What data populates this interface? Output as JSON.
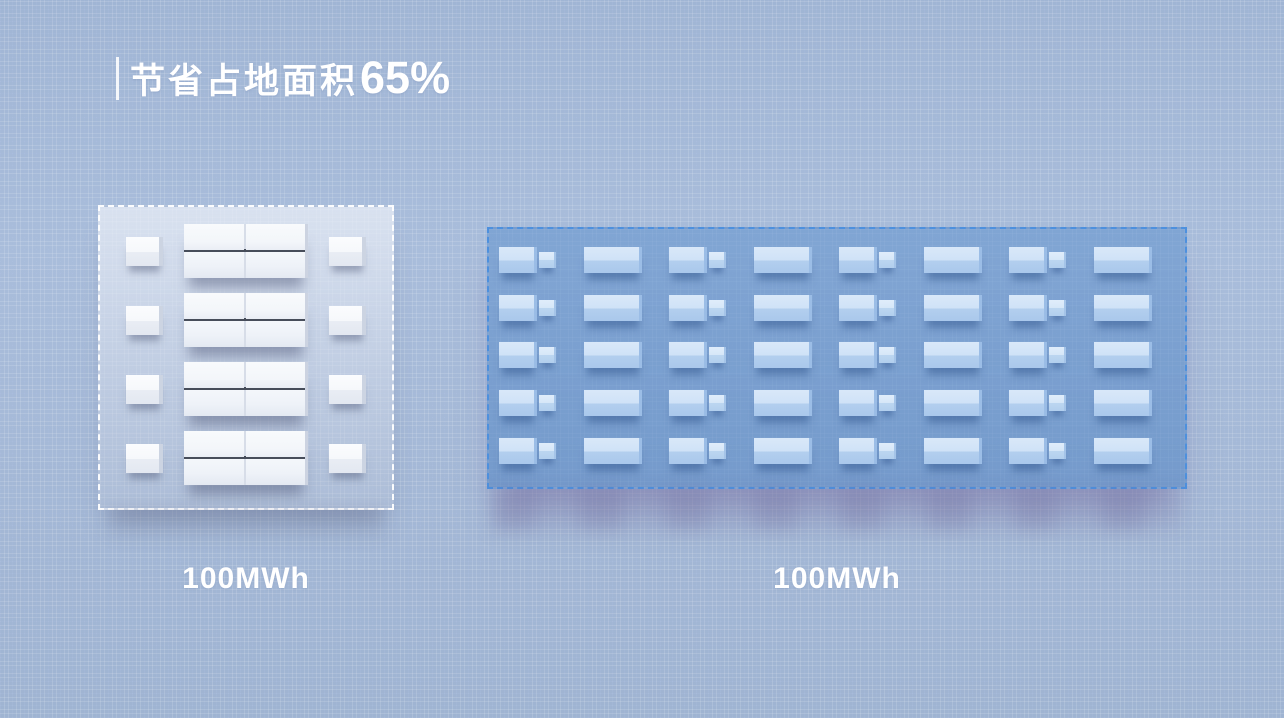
{
  "title": {
    "prefix": "节省占地面积",
    "percent": "65%"
  },
  "sites": {
    "left": {
      "label": "100MWh",
      "rows": 4,
      "aux_boxes_per_row": 2,
      "containers_per_block": 4,
      "border_style": "white-dashed"
    },
    "right": {
      "label": "100MWh",
      "rows": 5,
      "cols": 8,
      "unit_pattern": [
        "container-with-pcs",
        "container"
      ],
      "border_style": "blue-dashed"
    }
  },
  "colors": {
    "background": "#a6bad7",
    "title_text": "#ffffff",
    "left_platform": "#dde3ee",
    "left_box": "#f5f7fb",
    "right_platform": "#6d9bd3",
    "right_box": "#cde0f6",
    "right_border": "#4d90de",
    "label_text": "#ffffff"
  }
}
